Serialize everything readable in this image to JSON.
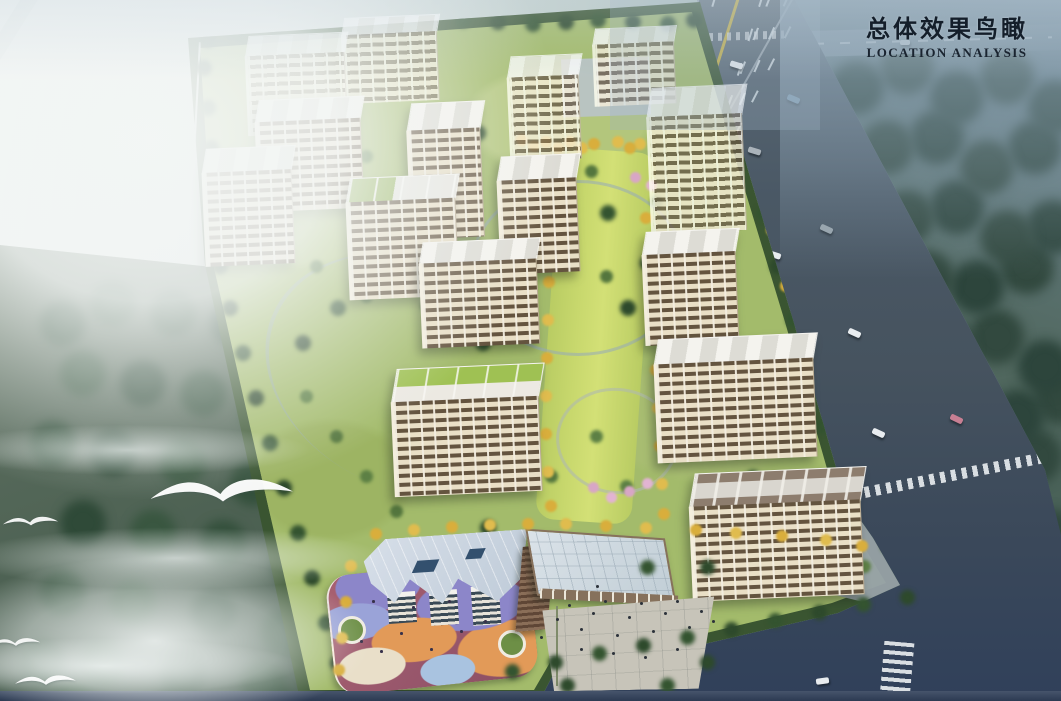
{
  "title_block": {
    "title_cn": "总体效果鸟瞰",
    "subtitle_en": "LOCATION ANALYSIS"
  },
  "scene": {
    "type": "architectural-aerial-rendering",
    "description": "Bird's-eye rendering of a residential development masterplan: rows of cream mid-rise towers with brown window bands around a golden-tree landscape axis; kindergarten with colorful playground and a glass-roofed commercial building with plaza at the south; an eight-lane highway with roadside trees and dark forest to the east; misty woodland with flying white birds to the west.",
    "labels": [
      "sky-haze",
      "west-forest",
      "east-forest",
      "main-highway",
      "north-road",
      "south-road",
      "intersection-crosswalk",
      "residential-tower",
      "central-landscape-axis",
      "rooftop-garden",
      "kindergarten",
      "playground",
      "commercial-building",
      "pergola-walkway",
      "plaza",
      "flying-bird",
      "mist-layer"
    ],
    "bird_count": 4
  },
  "colors": {
    "haze_sky": "#8fa5b5",
    "mist": "#eef3f2",
    "forest_west": "#4e6454",
    "forest_east": "#3c564c",
    "road_asphalt": "#46535f",
    "lane_yellow": "#c4ae3e",
    "lane_white": "#d7e0e5",
    "site_lawn": "#a3bb6b",
    "hedge_green": "#3a5531",
    "axis_lawn": "#c8d86d",
    "tree_dark": "#2e4a2c",
    "tree_medium": "#54763e",
    "tree_gold": "#d9ae3c",
    "blossom_pink": "#d8a6c6",
    "facade_cream": "#e9dfc6",
    "facade_band": "#64543f",
    "roof_light": "#dddcd5",
    "roof_brown": "#8d7d6e",
    "roof_garden_green": "#93b257",
    "kg_roof": "#c0ccd9",
    "kg_purple": "#8c86c9",
    "kg_orange": "#e29a58",
    "kg_rose": "#a86070",
    "kg_blue": "#a9c3e0",
    "mall_glass": "#c0cdd5",
    "plaza_grey": "#c7c4b9",
    "people_dot": "#2c323a",
    "title_text": "#141e2a",
    "bird_white": "#ffffff",
    "bottom_strip": "#2c3a52"
  }
}
